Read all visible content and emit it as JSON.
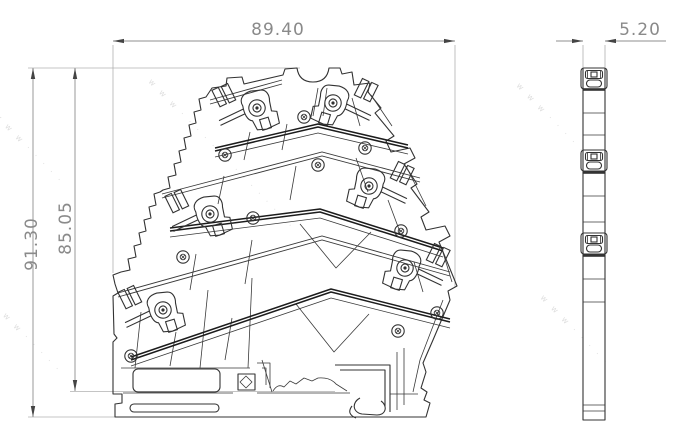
{
  "drawing_meta": {
    "background": "#ffffff",
    "line_color": "#333333",
    "dimension_color": "#8f8f8f",
    "dimension_text_color": "#8a8a8a"
  },
  "dimensions": {
    "width": {
      "label": "89.40"
    },
    "height_total": {
      "label": "91.30"
    },
    "height_upper": {
      "label": "85.05"
    },
    "thickness": {
      "label": "5.20"
    }
  },
  "watermark": {
    "text_long": "w w w · · · · · · · · · · · · · · ·",
    "text_short": "w w w · · · · ·",
    "angle": 46,
    "instances": [
      {
        "x": 148,
        "y": 82,
        "len": "long"
      },
      {
        "x": 516,
        "y": 86,
        "len": "short"
      },
      {
        "x": 540,
        "y": 298,
        "len": "short"
      },
      {
        "x": -6,
        "y": 116,
        "len": "short"
      },
      {
        "x": -8,
        "y": 305,
        "len": "short"
      }
    ]
  },
  "front_view": {
    "clamps": [
      {
        "x": 257,
        "y": 108,
        "side": "left"
      },
      {
        "x": 333,
        "y": 103,
        "side": "right"
      },
      {
        "x": 210,
        "y": 214,
        "side": "left"
      },
      {
        "x": 369,
        "y": 186,
        "side": "right"
      },
      {
        "x": 163,
        "y": 310,
        "side": "left"
      },
      {
        "x": 405,
        "y": 268,
        "side": "right"
      }
    ],
    "screws": [
      [
        304,
        117
      ],
      [
        225,
        155
      ],
      [
        318,
        165
      ],
      [
        365,
        148
      ],
      [
        253,
        218
      ],
      [
        183,
        257
      ],
      [
        131,
        356
      ],
      [
        398,
        331
      ],
      [
        437,
        313
      ],
      [
        401,
        231
      ]
    ],
    "busbars": [
      [
        [
          215,
          148
        ],
        [
          318,
          124
        ],
        [
          408,
          145
        ]
      ],
      [
        [
          170,
          228
        ],
        [
          320,
          209
        ],
        [
          443,
          248
        ]
      ],
      [
        [
          131,
          357
        ],
        [
          331,
          289
        ],
        [
          450,
          319
        ]
      ]
    ],
    "decks": [
      [
        [
          210,
          100
        ],
        [
          282,
          80
        ]
      ],
      [
        [
          162,
          194
        ],
        [
          322,
          152
        ],
        [
          420,
          178
        ]
      ],
      [
        [
          118,
          293
        ],
        [
          322,
          236
        ],
        [
          450,
          272
        ]
      ]
    ]
  },
  "side_view": {
    "x": 583,
    "width": 22,
    "top": 68,
    "bottom": 420,
    "caps": [
      68,
      150,
      233
    ],
    "bands": [
      89.5,
      172.5,
      255.5
    ],
    "lines": [
      113,
      135,
      196,
      222,
      279,
      302,
      405,
      411
    ]
  }
}
